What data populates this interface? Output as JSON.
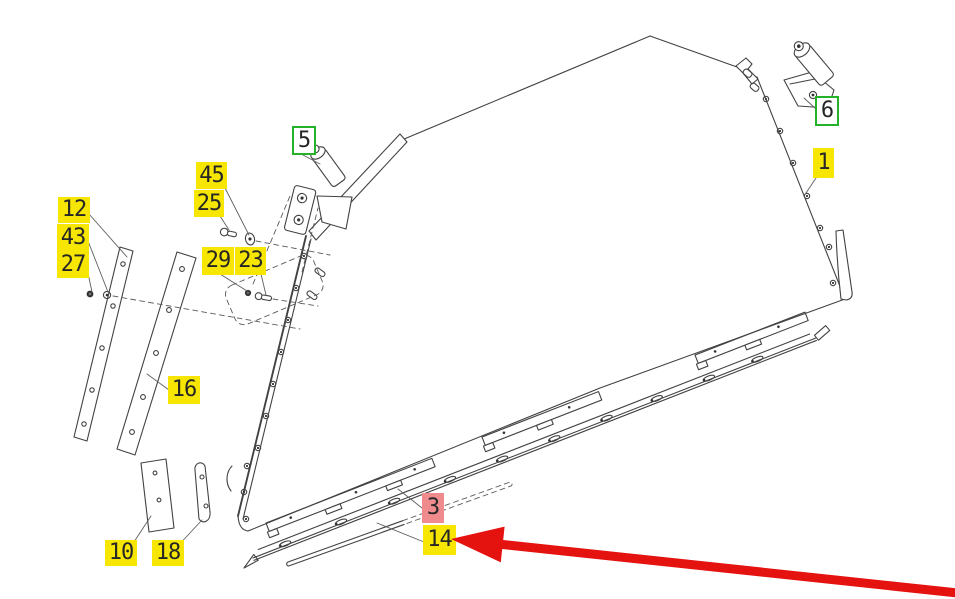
{
  "diagram": {
    "kind": "exploded-parts-diagram",
    "background": "#ffffff",
    "line_color": "#424242"
  },
  "callout_styles": {
    "yellow": {
      "bg": "#f6e602",
      "border": "",
      "text": "#262626"
    },
    "green": {
      "bg": "#ffffff",
      "border": "#24b328",
      "text": "#262626"
    },
    "pink": {
      "bg": "#ef8b8d",
      "border": "",
      "text": "#262626"
    }
  },
  "callouts": [
    {
      "part": "45",
      "style": "yellow",
      "x": 196,
      "y": 162,
      "w": 31,
      "h": 27,
      "leaders": [
        [
          225,
          188,
          249,
          235
        ]
      ]
    },
    {
      "part": "25",
      "style": "yellow",
      "x": 194,
      "y": 190,
      "w": 30,
      "h": 27,
      "leaders": [
        [
          220,
          216,
          229,
          230
        ]
      ]
    },
    {
      "part": "12",
      "style": "yellow",
      "x": 58,
      "y": 197,
      "w": 32,
      "h": 26,
      "leaders": [
        [
          89,
          214,
          127,
          257
        ]
      ]
    },
    {
      "part": "43",
      "style": "yellow",
      "x": 57,
      "y": 224,
      "w": 32,
      "h": 27,
      "leaders": [
        [
          88,
          241,
          108,
          292
        ]
      ]
    },
    {
      "part": "27",
      "style": "yellow",
      "x": 57,
      "y": 251,
      "w": 32,
      "h": 27,
      "leaders": [
        [
          86,
          264,
          92,
          292
        ]
      ]
    },
    {
      "part": "29",
      "style": "yellow",
      "x": 202,
      "y": 247,
      "w": 32,
      "h": 28,
      "leaders": [
        [
          220,
          274,
          247,
          291
        ]
      ]
    },
    {
      "part": "23",
      "style": "yellow",
      "x": 235,
      "y": 247,
      "w": 31,
      "h": 28,
      "leaders": [
        [
          261,
          274,
          266,
          295
        ]
      ]
    },
    {
      "part": "5",
      "style": "green",
      "x": 292,
      "y": 126,
      "w": 24,
      "h": 29,
      "leaders": [
        [
          303,
          155,
          320,
          164
        ]
      ]
    },
    {
      "part": "6",
      "style": "green",
      "x": 815,
      "y": 96,
      "w": 24,
      "h": 30,
      "leaders": [
        [
          816,
          109,
          804,
          98
        ]
      ]
    },
    {
      "part": "1",
      "style": "yellow",
      "x": 813,
      "y": 148,
      "w": 21,
      "h": 30,
      "leaders": [
        [
          816,
          178,
          806,
          193
        ]
      ]
    },
    {
      "part": "16",
      "style": "yellow",
      "x": 168,
      "y": 376,
      "w": 32,
      "h": 28,
      "leaders": [
        [
          169,
          390,
          147,
          374
        ]
      ]
    },
    {
      "part": "10",
      "style": "yellow",
      "x": 105,
      "y": 540,
      "w": 32,
      "h": 26,
      "leaders": [
        [
          130,
          548,
          151,
          516
        ]
      ]
    },
    {
      "part": "18",
      "style": "yellow",
      "x": 152,
      "y": 540,
      "w": 32,
      "h": 26,
      "leaders": [
        [
          176,
          548,
          202,
          520
        ]
      ]
    },
    {
      "part": "3",
      "style": "pink",
      "x": 422,
      "y": 493,
      "w": 22,
      "h": 30,
      "leaders": [
        [
          422,
          508,
          398,
          489
        ]
      ]
    },
    {
      "part": "14",
      "style": "yellow",
      "x": 423,
      "y": 525,
      "w": 33,
      "h": 30,
      "leaders": [
        [
          424,
          542,
          377,
          523
        ]
      ]
    }
  ],
  "arrow": {
    "color": "#e41310",
    "tip_x": 451,
    "tip_y": 539,
    "tail_x": 958,
    "tail_y": 593,
    "shaft_width": 9,
    "head_length": 52,
    "head_width": 36
  }
}
